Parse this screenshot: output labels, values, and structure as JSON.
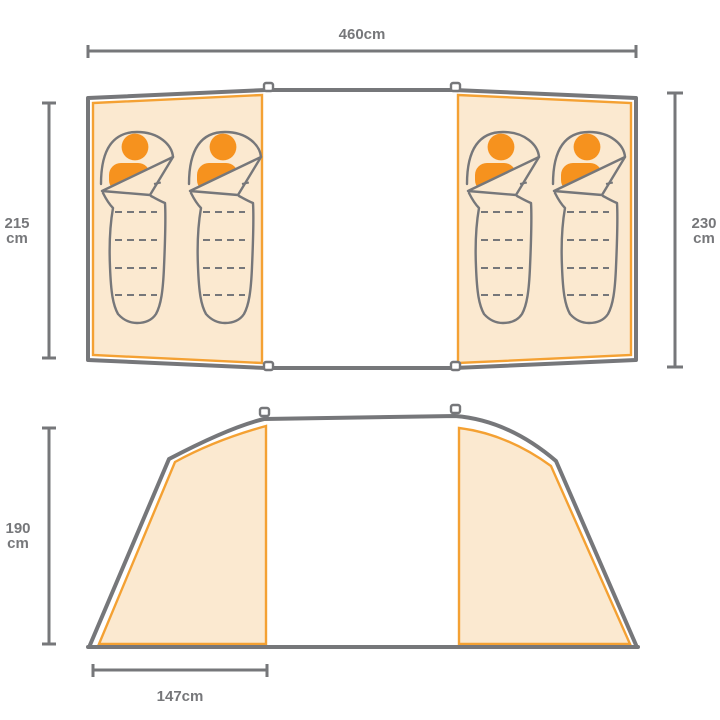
{
  "colors": {
    "outline_gray": "#76777A",
    "accent_orange": "#F4A133",
    "person_orange": "#F6921E",
    "panel_fill_cream": "#FBE9D0",
    "background": "#FFFFFF",
    "label_gray": "#76777A"
  },
  "top_view": {
    "total_width": {
      "label": "460cm"
    },
    "left_section_depth": {
      "value": "215",
      "unit": "cm"
    },
    "right_section_depth": {
      "value": "230",
      "unit": "cm"
    },
    "sleeping_bags": {
      "count": 4,
      "icon": "sleeping-bag-icon"
    }
  },
  "side_view": {
    "height": {
      "value": "190",
      "unit": "cm"
    },
    "left_section_width": {
      "label": "147cm"
    }
  },
  "icons": {
    "sleeping_bag": "sleeping-bag-icon",
    "person": "person-icon",
    "pole_connector": "pole-connector-icon"
  }
}
